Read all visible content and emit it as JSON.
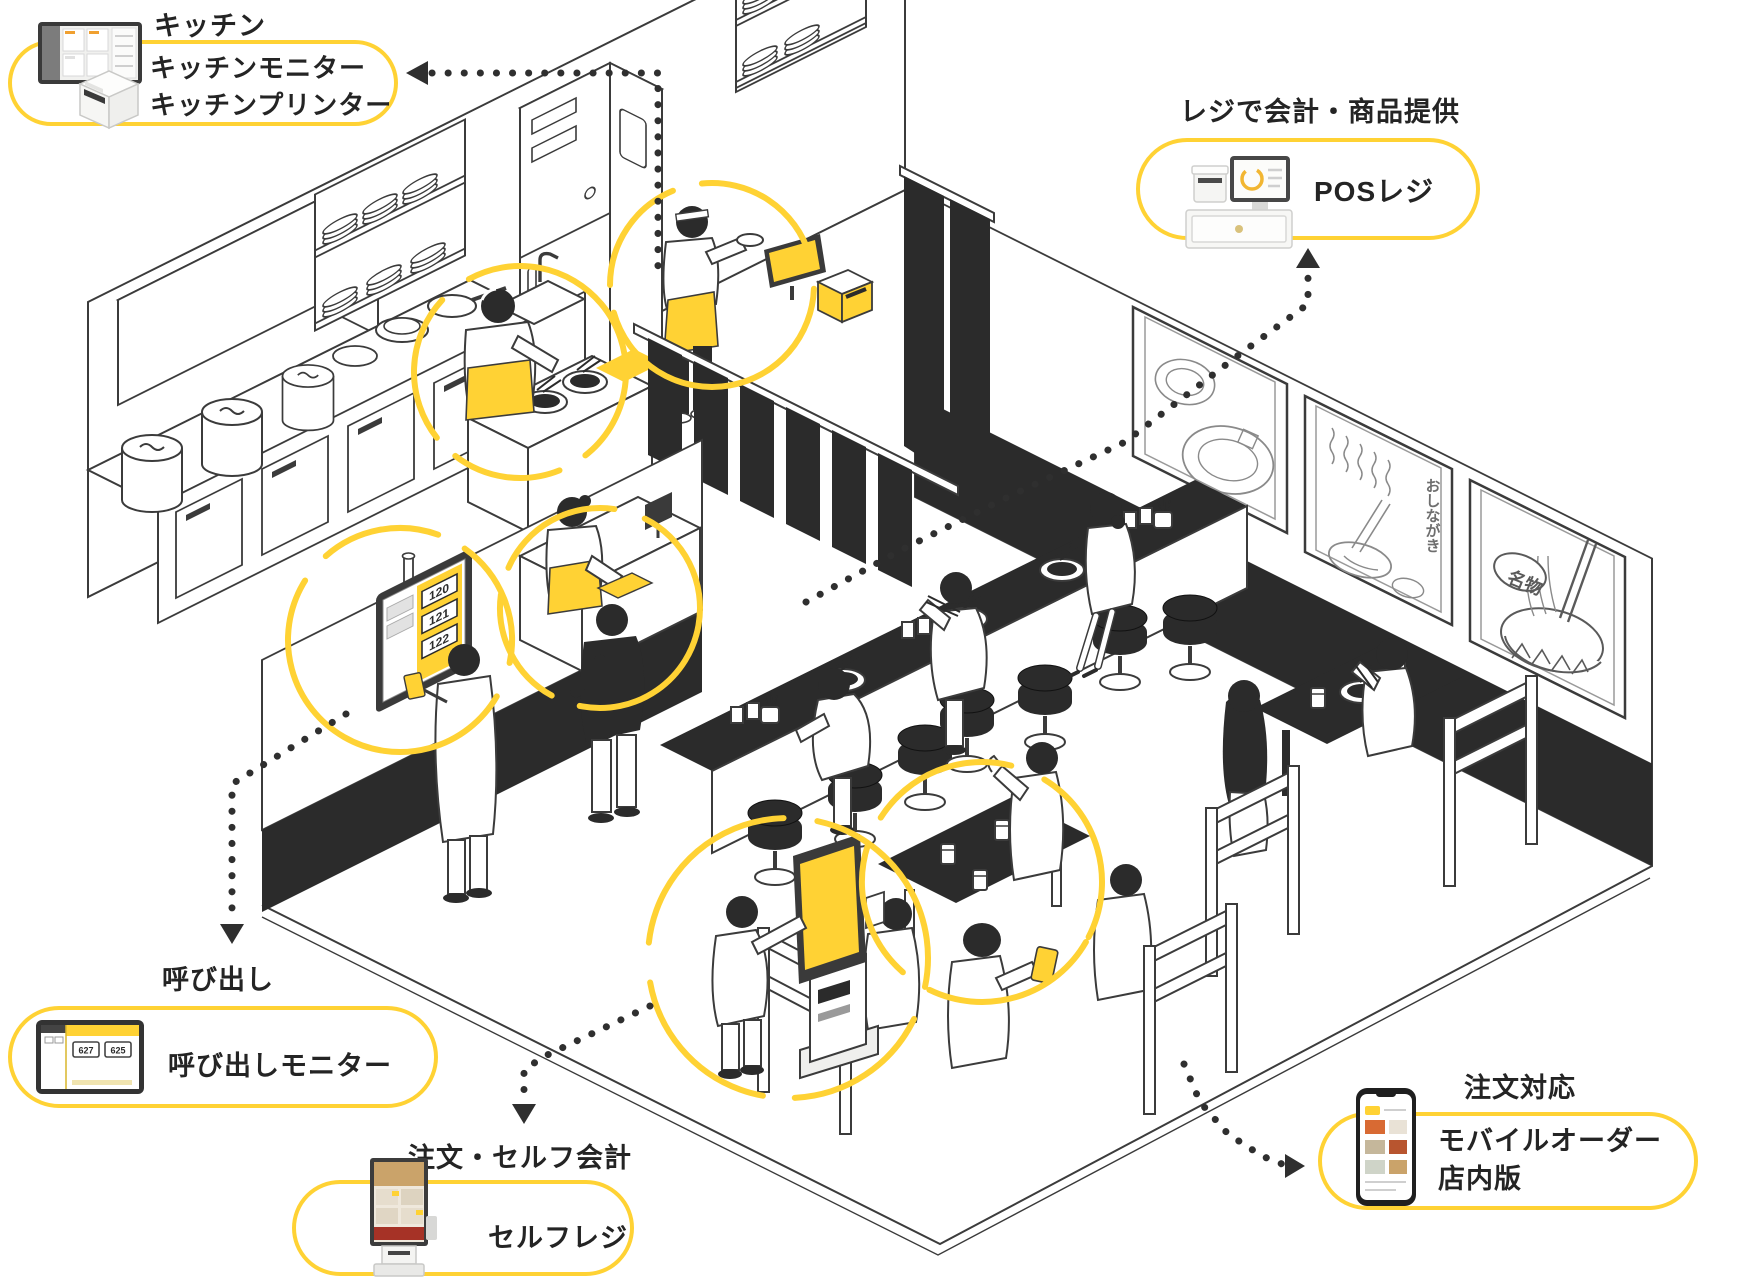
{
  "palette": {
    "yellow": "#FFD234",
    "ink": "#2b2b2b"
  },
  "callouts": {
    "kitchen": {
      "title": "キッチン",
      "line1": "キッチンモニター",
      "line2": "キッチンプリンター"
    },
    "pos": {
      "title": "レジで会計・商品提供",
      "label": "POSレジ"
    },
    "call": {
      "title": "呼び出し",
      "label": "呼び出しモニター"
    },
    "self_checkout": {
      "title": "注文・セルフ会計",
      "label": "セルフレジ"
    },
    "mobile_order": {
      "title": "注文対応",
      "label_line1": "モバイルオーダー",
      "label_line2": "店内版"
    }
  },
  "scene": {
    "call_monitor_numbers": [
      "120",
      "121",
      "122"
    ],
    "call_monitor_thumb_numbers": [
      "627",
      "625"
    ],
    "wall_art": {
      "menu_text": "おしながき",
      "stamp_text": "名物"
    }
  }
}
